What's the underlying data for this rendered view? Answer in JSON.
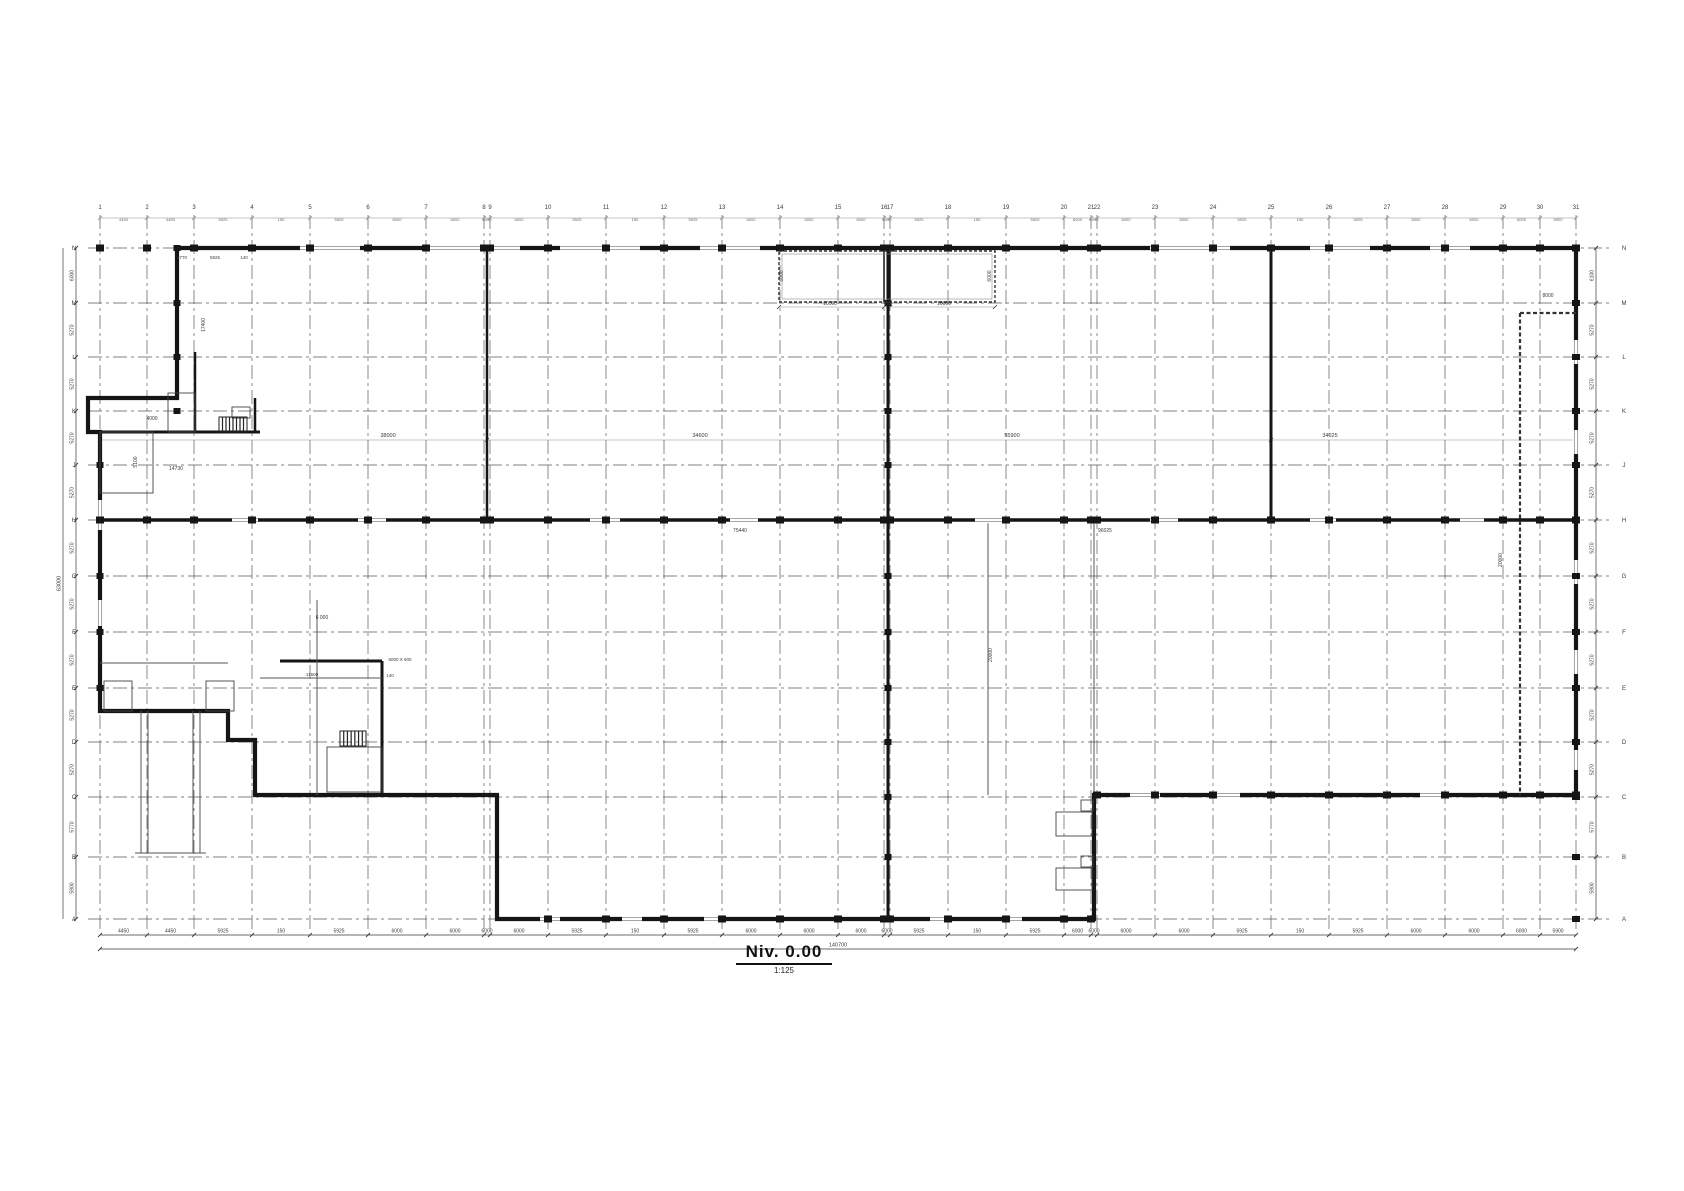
{
  "title": {
    "name": "Niv. 0.00",
    "scale": "1:125"
  },
  "colors": {
    "wall": "#151515",
    "grid": "#5a5a5a",
    "thin": "#8a8a8a",
    "dim": "#3a3a3a",
    "window": "#9a9a9a"
  },
  "grid": {
    "cols": {
      "labels": [
        "1",
        "2",
        "3",
        "4",
        "5",
        "6",
        "7",
        "8",
        "9",
        "10",
        "11",
        "12",
        "13",
        "14",
        "15",
        "16",
        "17",
        "18",
        "19",
        "20",
        "21",
        "22",
        "23",
        "24",
        "25",
        "26",
        "27",
        "28",
        "29",
        "30",
        "31"
      ],
      "x": [
        100,
        147,
        194,
        252,
        310,
        368,
        426,
        484,
        490,
        548,
        606,
        664,
        722,
        780,
        838,
        884,
        890,
        948,
        1006,
        1064,
        1091,
        1097,
        1155,
        1213,
        1271,
        1329,
        1387,
        1445,
        1503,
        1540,
        1576
      ],
      "top": 215,
      "bottom": 932
    },
    "rows": {
      "labels": [
        "N",
        "M",
        "L",
        "K",
        "J",
        "H",
        "G",
        "F",
        "E",
        "D",
        "C",
        "B",
        "A"
      ],
      "y": [
        248,
        303,
        357,
        411,
        465,
        520,
        576,
        632,
        688,
        742,
        797,
        857,
        919
      ],
      "left": 88,
      "right": 1610
    },
    "bottom_dims": [
      "4450",
      "4450",
      "5925",
      "150",
      "5925",
      "6000",
      "6000",
      "6000",
      "6000",
      "5925",
      "150",
      "5925",
      "6000",
      "6000",
      "6000",
      "6000",
      "5925",
      "150",
      "5925",
      "6000",
      "6000",
      "6000",
      "6000",
      "5925",
      "150",
      "5925",
      "6000",
      "6000",
      "6000",
      "5900"
    ],
    "bottom_total": "140700",
    "left_dims": [
      "6000",
      "5270",
      "5270",
      "5270",
      "5270",
      "5270",
      "5270",
      "5270",
      "5270",
      "5270",
      "5770",
      "5900"
    ],
    "left_total": "63000",
    "right_dims": [
      "6100",
      "5270",
      "5270",
      "5270",
      "5270",
      "5270",
      "5270",
      "5270",
      "5270",
      "5270",
      "5770",
      "5900"
    ]
  },
  "drawing": {
    "outline": "177,248 1576,248 1576,795 1094,795 1094,919 497,919 497,795 255,795 255,740 228,740 228,711 100,711 100,432 88,432 88,398 177,398",
    "walls": [
      {
        "x1": 888,
        "y1": 248,
        "x2": 888,
        "y2": 919,
        "w": 3
      },
      {
        "x1": 487,
        "y1": 248,
        "x2": 487,
        "y2": 520,
        "w": 2.5
      },
      {
        "x1": 1271,
        "y1": 248,
        "x2": 1271,
        "y2": 520,
        "w": 3
      },
      {
        "x1": 100,
        "y1": 520,
        "x2": 1576,
        "y2": 520,
        "w": 3.5
      },
      {
        "x1": 100,
        "y1": 432,
        "x2": 260,
        "y2": 432,
        "w": 3
      },
      {
        "x1": 195,
        "y1": 352,
        "x2": 195,
        "y2": 432,
        "w": 2.5
      },
      {
        "x1": 255,
        "y1": 398,
        "x2": 255,
        "y2": 432,
        "w": 2.5
      },
      {
        "x1": 280,
        "y1": 661,
        "x2": 382,
        "y2": 661,
        "w": 3
      },
      {
        "x1": 382,
        "y1": 661,
        "x2": 382,
        "y2": 793,
        "w": 3
      },
      {
        "x1": 884,
        "y1": 251,
        "x2": 884,
        "y2": 302,
        "w": 1.5
      },
      {
        "x1": 890,
        "y1": 251,
        "x2": 890,
        "y2": 302,
        "w": 1.5
      }
    ],
    "thin_walls": [
      {
        "x1": 1094,
        "y1": 520,
        "x2": 1094,
        "y2": 795
      },
      {
        "x1": 988,
        "y1": 520,
        "x2": 988,
        "y2": 795
      },
      {
        "x1": 317,
        "y1": 600,
        "x2": 317,
        "y2": 795
      },
      {
        "x1": 100,
        "y1": 663,
        "x2": 228,
        "y2": 663
      },
      {
        "x1": 260,
        "y1": 678,
        "x2": 382,
        "y2": 678
      },
      {
        "x1": 135,
        "y1": 853,
        "x2": 206,
        "y2": 853
      }
    ],
    "dashed_walls": [
      {
        "x1": 1520,
        "y1": 313,
        "x2": 1520,
        "y2": 795
      },
      {
        "x1": 1520,
        "y1": 313,
        "x2": 1576,
        "y2": 313
      }
    ],
    "canopy": {
      "x": 779,
      "y": 251,
      "w": 216,
      "h": 51
    },
    "ramps": [
      {
        "x": 141,
        "y1": 711,
        "y2": 853
      },
      {
        "x": 148,
        "y1": 711,
        "y2": 853
      },
      {
        "x": 193,
        "y1": 711,
        "y2": 853
      },
      {
        "x": 200,
        "y1": 711,
        "y2": 853
      }
    ],
    "rects": [
      {
        "x": 168,
        "y": 393,
        "w": 27,
        "h": 39
      },
      {
        "x": 100,
        "y": 432,
        "w": 53,
        "h": 61
      },
      {
        "x": 232,
        "y": 407,
        "w": 18,
        "h": 11
      },
      {
        "x": 327,
        "y": 747,
        "w": 55,
        "h": 45
      },
      {
        "x": 104,
        "y": 681,
        "w": 28,
        "h": 30
      },
      {
        "x": 206,
        "y": 681,
        "w": 28,
        "h": 30
      },
      {
        "x": 1056,
        "y": 812,
        "w": 36,
        "h": 24
      },
      {
        "x": 1056,
        "y": 868,
        "w": 36,
        "h": 22
      },
      {
        "x": 1081,
        "y": 800,
        "w": 12,
        "h": 11
      },
      {
        "x": 1081,
        "y": 856,
        "w": 12,
        "h": 11
      }
    ],
    "stairs": [
      {
        "x": 219,
        "y": 417,
        "w": 28,
        "h": 15,
        "n": 8
      },
      {
        "x": 340,
        "y": 731,
        "w": 26,
        "h": 15,
        "n": 7
      }
    ],
    "openings_h": [
      {
        "wally": 248,
        "x": 300,
        "len": 60
      },
      {
        "wally": 248,
        "x": 430,
        "len": 90
      },
      {
        "wally": 248,
        "x": 560,
        "len": 80
      },
      {
        "wally": 248,
        "x": 700,
        "len": 60
      },
      {
        "wally": 248,
        "x": 1150,
        "len": 80
      },
      {
        "wally": 248,
        "x": 1310,
        "len": 60
      },
      {
        "wally": 248,
        "x": 1430,
        "len": 40
      },
      {
        "wally": 520,
        "x": 232,
        "len": 26
      },
      {
        "wally": 520,
        "x": 358,
        "len": 28
      },
      {
        "wally": 520,
        "x": 590,
        "len": 30
      },
      {
        "wally": 520,
        "x": 730,
        "len": 28
      },
      {
        "wally": 520,
        "x": 975,
        "len": 30
      },
      {
        "wally": 520,
        "x": 1150,
        "len": 28
      },
      {
        "wally": 520,
        "x": 1310,
        "len": 26
      },
      {
        "wally": 520,
        "x": 1460,
        "len": 24
      },
      {
        "wally": 919,
        "x": 540,
        "len": 20
      },
      {
        "wally": 919,
        "x": 622,
        "len": 20
      },
      {
        "wally": 919,
        "x": 704,
        "len": 18
      },
      {
        "wally": 919,
        "x": 930,
        "len": 20
      },
      {
        "wally": 919,
        "x": 1004,
        "len": 18
      },
      {
        "wally": 795,
        "x": 1130,
        "len": 30
      },
      {
        "wally": 795,
        "x": 1210,
        "len": 30
      },
      {
        "wally": 795,
        "x": 1420,
        "len": 22
      }
    ],
    "openings_v": [
      {
        "wallx": 100,
        "y": 500,
        "len": 30
      },
      {
        "wallx": 100,
        "y": 600,
        "len": 26
      },
      {
        "wallx": 1576,
        "y": 340,
        "len": 24
      },
      {
        "wallx": 1576,
        "y": 430,
        "len": 24
      },
      {
        "wallx": 1576,
        "y": 560,
        "len": 24
      },
      {
        "wallx": 1576,
        "y": 650,
        "len": 24
      },
      {
        "wallx": 1576,
        "y": 750,
        "len": 20
      }
    ],
    "dim_lines": [
      {
        "y": 440,
        "x1": 100,
        "x2": 1576,
        "ticks": [
          100,
          487,
          888,
          1271,
          1576
        ]
      },
      {
        "y": 307,
        "x1": 779,
        "x2": 995,
        "ticks": [
          779,
          884,
          890,
          995
        ]
      }
    ],
    "annotations": [
      {
        "x": 388,
        "y": 437,
        "t": "38000",
        "fs": 5.5
      },
      {
        "x": 700,
        "y": 437,
        "t": "34600",
        "fs": 5.5
      },
      {
        "x": 1012,
        "y": 437,
        "t": "55900",
        "fs": 5.5
      },
      {
        "x": 1330,
        "y": 437,
        "t": "34025",
        "fs": 5.5
      },
      {
        "x": 176,
        "y": 470,
        "t": "14730",
        "fs": 5
      },
      {
        "x": 740,
        "y": 532,
        "t": "75440",
        "fs": 5
      },
      {
        "x": 1105,
        "y": 532,
        "t": "96025",
        "fs": 5
      },
      {
        "x": 830,
        "y": 305,
        "t": "10000",
        "fs": 5
      },
      {
        "x": 888,
        "y": 305,
        "t": "150",
        "fs": 4.5
      },
      {
        "x": 944,
        "y": 305,
        "t": "10000",
        "fs": 5
      },
      {
        "x": 783,
        "y": 276,
        "t": "6000",
        "r": 90,
        "fs": 5
      },
      {
        "x": 991,
        "y": 276,
        "t": "6000",
        "r": 90,
        "fs": 5
      },
      {
        "x": 1548,
        "y": 297,
        "t": "8000",
        "fs": 5
      },
      {
        "x": 1502,
        "y": 560,
        "t": "20000",
        "r": 90,
        "fs": 5
      },
      {
        "x": 992,
        "y": 655,
        "t": "20000",
        "r": 90,
        "fs": 5
      },
      {
        "x": 205,
        "y": 325,
        "t": "17400",
        "r": 90,
        "fs": 5
      },
      {
        "x": 137,
        "y": 462,
        "t": "5100",
        "r": 90,
        "fs": 5
      },
      {
        "x": 152,
        "y": 420,
        "t": "4000",
        "fs": 5
      },
      {
        "x": 182,
        "y": 259,
        "t": "2770",
        "fs": 4.5
      },
      {
        "x": 215,
        "y": 259,
        "t": "5925",
        "fs": 4.5
      },
      {
        "x": 244,
        "y": 259,
        "t": "140",
        "fs": 4.5
      },
      {
        "x": 322,
        "y": 619,
        "t": "6 000",
        "fs": 5
      },
      {
        "x": 312,
        "y": 676,
        "t": "11500",
        "fs": 4.5
      },
      {
        "x": 390,
        "y": 677,
        "t": "140",
        "fs": 4.5
      },
      {
        "x": 400,
        "y": 661,
        "t": "6000 X 600",
        "fs": 4.5
      }
    ]
  }
}
